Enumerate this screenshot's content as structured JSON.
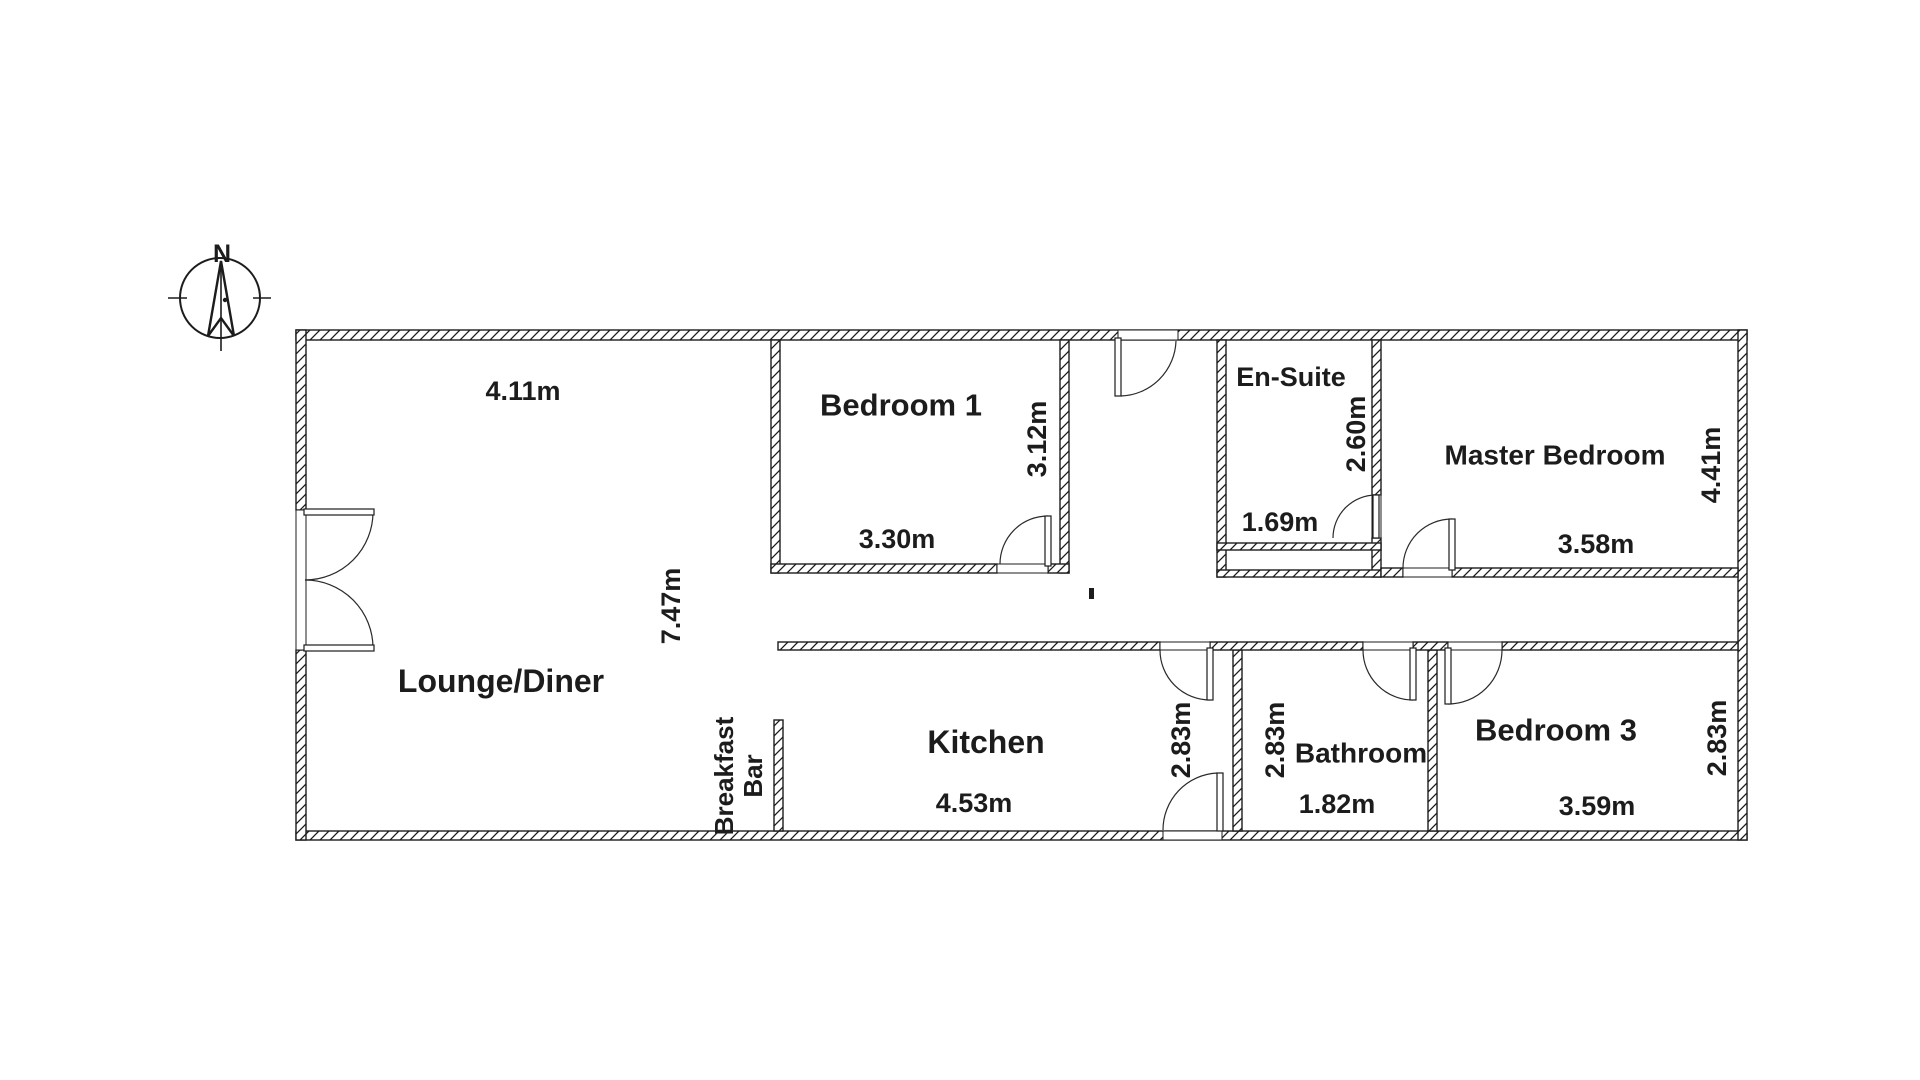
{
  "compass": {
    "north_label": "N"
  },
  "rooms": [
    {
      "id": "lounge-diner",
      "name": "Lounge/Diner",
      "width": "4.11m",
      "depth": "7.47m"
    },
    {
      "id": "bedroom-1",
      "name": "Bedroom 1",
      "width": "3.30m",
      "depth": "3.12m"
    },
    {
      "id": "en-suite",
      "name": "En-Suite",
      "width": "1.69m",
      "depth": "2.60m"
    },
    {
      "id": "master-bedroom",
      "name": "Master Bedroom",
      "width": "3.58m",
      "depth": "4.41m"
    },
    {
      "id": "kitchen",
      "name": "Kitchen",
      "width": "4.53m",
      "depth": "2.83m"
    },
    {
      "id": "bathroom",
      "name": "Bathroom",
      "width": "1.82m",
      "depth": "2.83m"
    },
    {
      "id": "bedroom-3",
      "name": "Bedroom 3",
      "width": "3.59m",
      "depth": "2.83m"
    }
  ],
  "features": {
    "breakfast_bar_line1": "Breakfast",
    "breakfast_bar_line2": "Bar"
  },
  "colors": {
    "line": "#1c1c1c",
    "background": "#ffffff"
  }
}
